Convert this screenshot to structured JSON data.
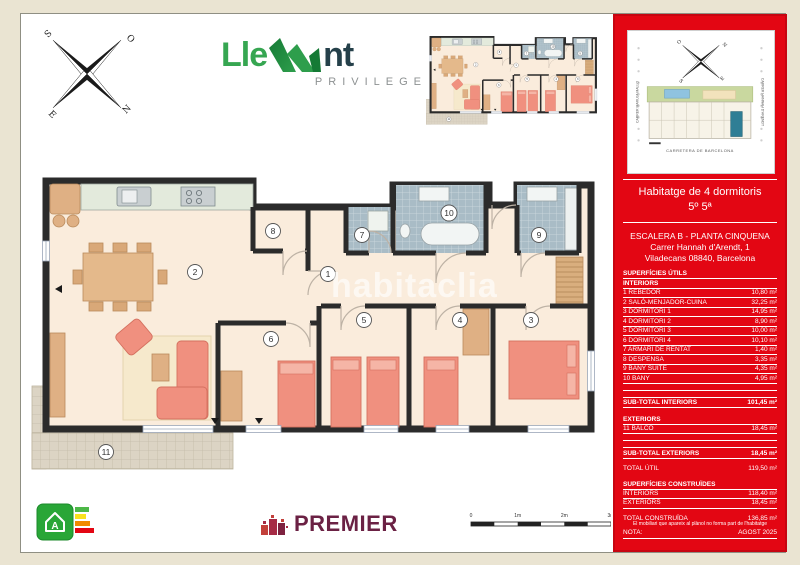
{
  "brand": {
    "name_left": "Lle",
    "name_right": "nt",
    "tagline": "PRIVILEGE"
  },
  "compass_main": {
    "nw": "S",
    "ne": "O",
    "sw": "E",
    "se": "N"
  },
  "watermark": "habitaclia",
  "plan": {
    "rooms": {
      "n1": "1",
      "n2": "2",
      "n3": "3",
      "n4": "4",
      "n5": "5",
      "n6": "6",
      "n7": "7",
      "n8": "8",
      "n9": "9",
      "n10": "10",
      "n11": "11"
    }
  },
  "scalebar": {
    "t0": "0",
    "t1": "1m",
    "t2": "2m",
    "t3": "3m"
  },
  "energy": {
    "letter": "A"
  },
  "premier": {
    "name": "PREMIER"
  },
  "siteplan": {
    "street_left": "CARRER MARUJA MALLO",
    "street_right": "CARRER HANNAH D'ARENDT",
    "street_bottom": "CARRETERA DE BARCELONA",
    "compass": {
      "nw": "O",
      "ne": "N",
      "sw": "S",
      "se": "E"
    }
  },
  "sidebar": {
    "title": "Habitatge de 4 dormitoris",
    "subtitle": "5º 5ª",
    "block": "ESCALERA B - PLANTA CINQUENA",
    "address1": "Carrer Hannah d'Arendt, 1",
    "address2": "Viladecans 08840, Barcelona",
    "surfaces_title": "SUPERFÍCIES ÚTILS",
    "interiors_label": "INTERIORS",
    "rows": [
      {
        "label": "1 REBEDOR",
        "value": "10,80 m²"
      },
      {
        "label": "2 SALÓ-MENJADOR-CUINA",
        "value": "32,25 m²"
      },
      {
        "label": "3 DORMITORI 1",
        "value": "14,95 m²"
      },
      {
        "label": "4 DORMITORI 2",
        "value": "8,90 m²"
      },
      {
        "label": "5 DORMITORI 3",
        "value": "10,00 m²"
      },
      {
        "label": "6 DORMITORI 4",
        "value": "10,10 m²"
      },
      {
        "label": "7 ARMARI DE RENTAT",
        "value": "1,40 m²"
      },
      {
        "label": "8 DESPENSA",
        "value": "3,35 m²"
      },
      {
        "label": "9 BANY SUITE",
        "value": "4,35 m²"
      },
      {
        "label": "10 BANY",
        "value": "4,95 m²"
      }
    ],
    "subtotal_interiors_label": "SUB-TOTAL INTERIORS",
    "subtotal_interiors_value": "101,45 m²",
    "exteriors_label": "EXTERIORS",
    "exterior_rows": [
      {
        "label": "11 BALCÓ",
        "value": "18,45 m²"
      }
    ],
    "subtotal_exteriors_label": "SUB-TOTAL EXTERIORS",
    "subtotal_exteriors_value": "18,45 m²",
    "total_util_label": "TOTAL ÚTIL",
    "total_util_value": "119,50 m²",
    "built_title": "SUPERFÍCIES CONSTRUÏDES",
    "built_rows": [
      {
        "label": "INTERIORS",
        "value": "118,40 m²"
      },
      {
        "label": "EXTERIORS",
        "value": "18,45 m²"
      }
    ],
    "total_built_label": "TOTAL CONSTRUÏDA",
    "total_built_value": "136,85 m²",
    "nota_label": "NOTA:",
    "nota_value": "AGOST 2025",
    "footnote": "El mobiliari que apareix al plànol no forma part de l'habitatge"
  }
}
